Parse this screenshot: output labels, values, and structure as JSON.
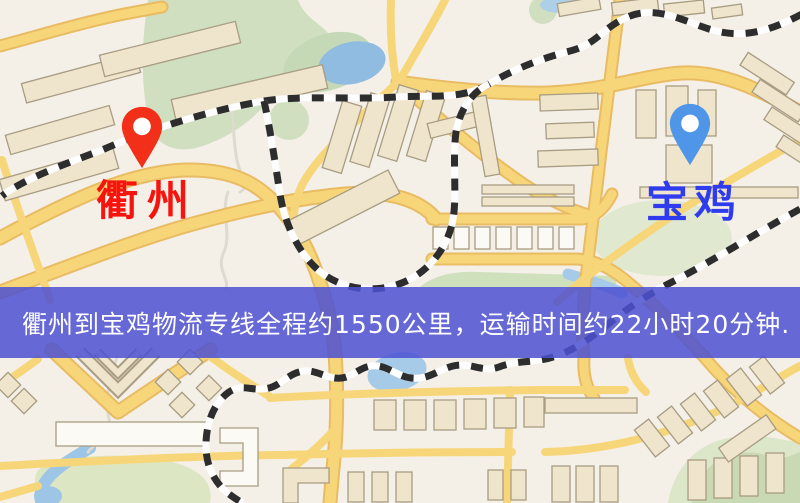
{
  "map": {
    "origin": {
      "label": "衢州",
      "label_color": "#f5150e",
      "pin_color": "#f23019",
      "pin_icon": "map-marker-icon"
    },
    "destination": {
      "label": "宝鸡",
      "label_color": "#2f3cee",
      "pin_color": "#4f95e8",
      "pin_icon": "map-marker-icon"
    }
  },
  "banner": {
    "text": "衢州到宝鸡物流专线全程约1550公里，运输时间约22小时20分钟.",
    "bg_color": "#4d51d2",
    "text_color": "#ffffff"
  },
  "map_palette": {
    "background": "#f4f0e8",
    "road": "#f7d67a",
    "road_casing": "#e9bb63",
    "building": "#efe5cc",
    "building_outline": "#a89c82",
    "park_green": "#cfdfc0",
    "water_blue": "#93bee2",
    "railway": "#2d2d2d"
  }
}
